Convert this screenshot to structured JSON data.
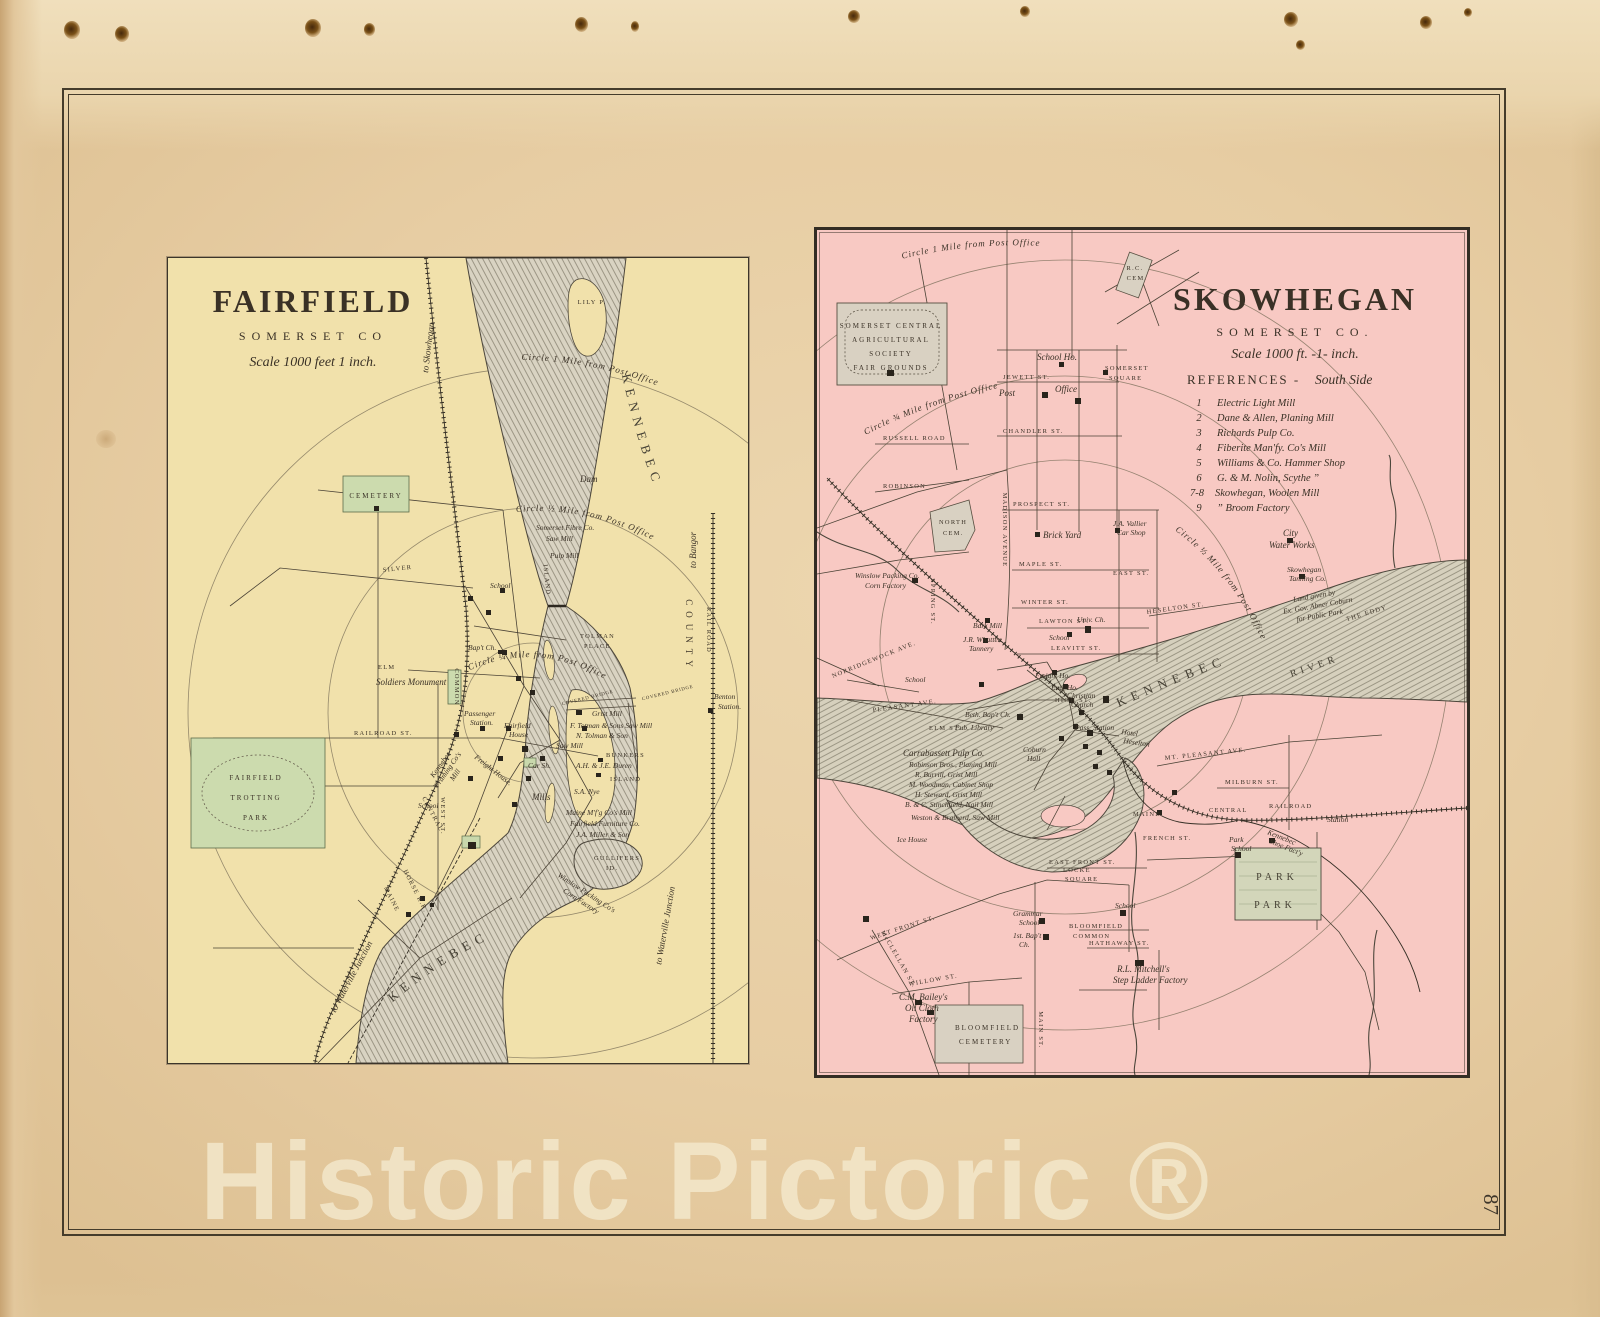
{
  "page": {
    "number": "87",
    "watermark": "Historic Pictoric ®"
  },
  "fairfield": {
    "title": "FAIRFIELD",
    "subtitle": "SOMERSET   CO",
    "scale": "Scale 1000 feet 1 inch.",
    "arcs": {
      "mile1": "Circle 1 Mile from Post Office",
      "half": "Circle ½ Mile from Post Office",
      "quarter": "Circle ¼ Mile from Post Office"
    },
    "river": {
      "top": "KENNEBEC",
      "bottom": "KENNEBEC"
    },
    "labels": {
      "lily": "LILY P.",
      "to_skowhegan": "to Skowhegan",
      "cemetery": "CEMETERY",
      "dam": "Dam",
      "somerset_fibre": "Somerset Fibre Co.",
      "saw_mill_n": "Saw Mill",
      "pulp_mill": "Pulp Mill",
      "school_n": "School",
      "school_s": "School",
      "tolman_1": "TOLMAN",
      "tolman_2": "PLACE",
      "island_st": "ISLAND",
      "soldiers": "Soldiers Monument",
      "common": "COMMON",
      "elm": "ELM",
      "silver": "SILVER",
      "west": "WEST  ST.",
      "railroad_st": "RAILROAD  ST.",
      "central": "CENTRAL",
      "bapt": "Bap't Ch.",
      "passenger_1": "Passenger",
      "passenger_2": "Station.",
      "house_1": "Fairfield",
      "house_2": "House",
      "grist_mill": "Grist Mill",
      "saw_mill_s": "Saw Mill",
      "totman": "F. Totman & Sons Saw Mill",
      "tolman_son": "N. Tolman & Son",
      "bunkers_1": "BUNKERS",
      "bunkers_2": "ISLAND",
      "duren": "A.H. & J.E. Duren",
      "nye": "S.A. Nye",
      "covered_1": "COVERED BRIDGE",
      "covered_2": "COVERED BRIDGE",
      "freight": "Freight House.",
      "car_shop": "Car Sh.",
      "mills": "Mills",
      "maine_mfg": "Maine M'f'g Co's Mill",
      "furniture": "Fairfield Furniture Co.",
      "miller": "J.A. Miller & Son",
      "framing_1": "Kennebec",
      "framing_2": "Framing Co's",
      "framing_3": "Mill",
      "trotting_1": "FAIRFIELD",
      "trotting_2": "TROTTING",
      "trotting_3": "PARK",
      "gullifers_1": "GULLIFERS",
      "gullifers_2": "ID.",
      "winslow_1": "Winslow Packing Co's",
      "winslow_2": "Corn Factory",
      "benton_1": "Benton",
      "benton_2": "Station.",
      "county": "COUNTY",
      "rail_road": "RAIL ROAD",
      "to_bangor": "to Bangor",
      "maine_rr": "MAINE",
      "horse_rr": "HORSE R.R.",
      "to_waterville_w": "to Waterville Junction",
      "to_waterville_e": "to Waterville Junction"
    }
  },
  "skowhegan": {
    "title": "SKOWHEGAN",
    "subtitle": "SOMERSET CO.",
    "scale": "Scale 1000 ft. -1- inch.",
    "references": {
      "heading": "REFERENCES -",
      "side": "South Side",
      "items": [
        {
          "n": "1",
          "t": "Electric Light Mill"
        },
        {
          "n": "2",
          "t": "Dane & Allen, Planing Mill"
        },
        {
          "n": "3",
          "t": "Richards Pulp Co."
        },
        {
          "n": "4",
          "t": "Fiberite Man'fy. Co's Mill"
        },
        {
          "n": "5",
          "t": "Williams & Co. Hammer Shop"
        },
        {
          "n": "6",
          "t": "G. & M. Nolin, Scythe  ”"
        },
        {
          "n": "7-8",
          "t": "Skowhegan, Woolen Mill"
        },
        {
          "n": "9",
          "t": "”        Broom Factory"
        }
      ]
    },
    "arcs": {
      "mile1": "Circle 1 Mile from Post Office",
      "three4": "Circle ¾ Mile from Post Office",
      "half": "Circle ½ Mile from Post Office"
    },
    "river": {
      "kennebec": "KENNEBEC",
      "river": "RIVER",
      "eddy": "THE EDDY"
    },
    "labels": {
      "fair_1": "SOMERSET CENTRAL",
      "fair_2": "AGRICULTURAL",
      "fair_3": "SOCIETY",
      "fair_4": "FAIR GROUNDS",
      "rc_cem_1": "R.C.",
      "rc_cem_2": "CEM.",
      "school_ho": "School Ho.",
      "somerset_sq_1": "SOMERSET",
      "somerset_sq_2": "SQUARE",
      "post": "Post",
      "office": "Office",
      "jewett": "JEWETT  ST.",
      "chandler": "CHANDLER  ST.",
      "russell": "RUSSELL  ROAD",
      "robinson": "ROBINSON",
      "madison": "MADISON  AVENUE",
      "north_cem_1": "NORTH",
      "north_cem_2": "CEM.",
      "prospect": "PROSPECT  ST.",
      "brick_yard": "Brick Yard",
      "vallier_1": "J.A. Vallier",
      "vallier_2": "Car Shop",
      "maple": "MAPLE  ST.",
      "winter": "WINTER  ST.",
      "east": "EAST  ST.",
      "spring": "SPRING ST.",
      "winslow_1": "Winslow Packing Co.",
      "winslow_2": "Corn Factory",
      "bark_mill": "Bark Mill",
      "whatten_1": "J.R. Whatten",
      "whatten_2": "Tannery",
      "lawton": "LAWTON  ST.",
      "school_c": "School",
      "univ_ch": "Univ. Ch.",
      "leavitt": "LEAVITT  ST.",
      "heselton": "HESELTON  ST.",
      "school_w": "School",
      "freight_ho": "Freight Ho.",
      "eng_ho": "Eng. Ho.",
      "christian_1": "Christian",
      "christian_2": "Church",
      "high": "HIGH  ST.",
      "pass_station": "Pass. Station",
      "hotel_1": "Hotel",
      "hotel_2": "Heselton",
      "coburn_1": "Coburn",
      "coburn_2": "Hall",
      "city_ww_1": "City",
      "city_ww_2": "Water Works",
      "tanning_1": "Skowhegan",
      "tanning_2": "Tanning Co.",
      "land_1": "Land given by",
      "land_2": "Ex. Gov. Abner Coburn",
      "land_3": "for Public Park",
      "mt_pleasant": "MT. PLEASANT  AVE.",
      "milburn": "MILBURN  ST.",
      "maine": "MAINE",
      "central": "CENTRAL",
      "railroad": "RAILROAD",
      "shoe_1": "Kennebec",
      "shoe_2": "Shoe Fact'y",
      "station": "Station",
      "park_school_1": "Park",
      "park_school_2": "School",
      "park_1": "PARK",
      "park_2": "PARK",
      "french": "FRENCH  ST.",
      "east_front": "EAST  FRONT  ST.",
      "locke_1": "LOCKE",
      "locke_2": "SQUARE",
      "carrabassett": "Carrabassett Pulp Co.",
      "carr_1": "Robinson Bros., Planing Mill",
      "carr_2": "R. Burrill, Grist Mill",
      "carr_3": "M. Woodman, Cabinet Shop",
      "carr_4": "H. Steward, Grist Mill",
      "carr_5": "B. & C. Stinchfield, Nail Mill",
      "weston": "Weston & Brainerd, Saw Mill",
      "ice_house": "Ice House",
      "beth": "Beth. Bap't Ch.",
      "library": "Pub. Library",
      "elm": "ELM  ST.",
      "pleasant": "PLEASANT  AVE.",
      "norridgewock": "NORRIDGEWOCK  AVE.",
      "west_front": "WEST  FRONT  ST.",
      "grammar_1": "Grammar",
      "grammar_2": "School",
      "bapt_1": "1st. Bap't",
      "bapt_2": "Ch.",
      "bloom_common_1": "BLOOMFIELD",
      "bloom_common_2": "COMMON",
      "hathaway": "HATHAWAY  ST.",
      "mitchell_1": "R.L. Mitchell's",
      "mitchell_2": "Step Ladder Factory",
      "bailey_1": "C.M. Bailey's",
      "bailey_2": "Oil Cloth",
      "bailey_3": "Factory",
      "willow": "WILLOW  ST.",
      "main": "MAIN  ST.",
      "mcclellan": "McCLELLAN  ST.",
      "school_s": "School",
      "bloom_cem_1": "BLOOMFIELD",
      "bloom_cem_2": "CEMETERY"
    }
  }
}
